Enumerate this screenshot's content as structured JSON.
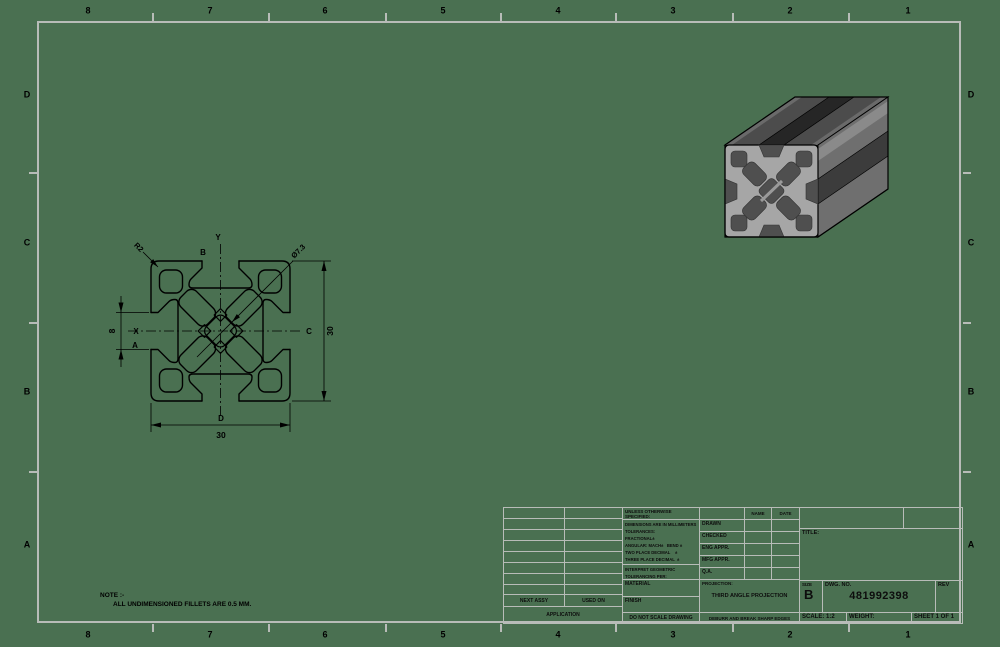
{
  "sheet": {
    "zone_cols": [
      "8",
      "7",
      "6",
      "5",
      "4",
      "3",
      "2",
      "1"
    ],
    "zone_rows": [
      "D",
      "C",
      "B",
      "A"
    ],
    "note": {
      "line1": "NOTE :-",
      "line2": "ALL UNDIMENSIONED FILLETS ARE 0.5 MM."
    },
    "background_color": "#4a7051",
    "line_color": "#b8bcb8"
  },
  "view": {
    "dim_width": "30",
    "dim_height": "30",
    "dim_slot_width": "8",
    "radius_callout": "R2",
    "diameter_callout": "Ø7.3",
    "labels": {
      "x": "X",
      "y": "Y",
      "a": "A",
      "b": "B",
      "c": "C",
      "d": "D"
    }
  },
  "title_block": {
    "unless": "UNLESS OTHERWISE SPECIFIED:",
    "tolerances": "DIMENSIONS ARE IN MILLIMETERS\nTOLERANCES:\nFRACTIONAL±\nANGULAR: MACH±   BEND ±\nTWO PLACE DECIMAL    ±\nTHREE PLACE DECIMAL  ±",
    "interpret": "INTERPRET GEOMETRIC\nTOLERANCING PER:",
    "material": "MATERIAL",
    "finish": "FINISH",
    "do_not_scale": "DO NOT SCALE DRAWING",
    "name_header": "NAME",
    "date_header": "DATE",
    "rows": [
      "DRAWN",
      "CHECKED",
      "ENG APPR.",
      "MFG APPR.",
      "Q.A."
    ],
    "projection_label": "PROJECTION:",
    "projection": "THIRD ANGLE PROJECTION",
    "deburr": "DEBURR AND BREAK SHARP EDGES",
    "title_label": "TITLE:",
    "size_label": "SIZE",
    "size_value": "B",
    "dwg_label": "DWG.  NO.",
    "dwg_number": "481992398",
    "rev_label": "REV",
    "scale": "SCALE: 1:2",
    "weight": "WEIGHT:",
    "sheet_of": "SHEET 1 OF 1",
    "next_assy": "NEXT ASSY",
    "used_on": "USED ON",
    "application": "APPLICATION"
  }
}
